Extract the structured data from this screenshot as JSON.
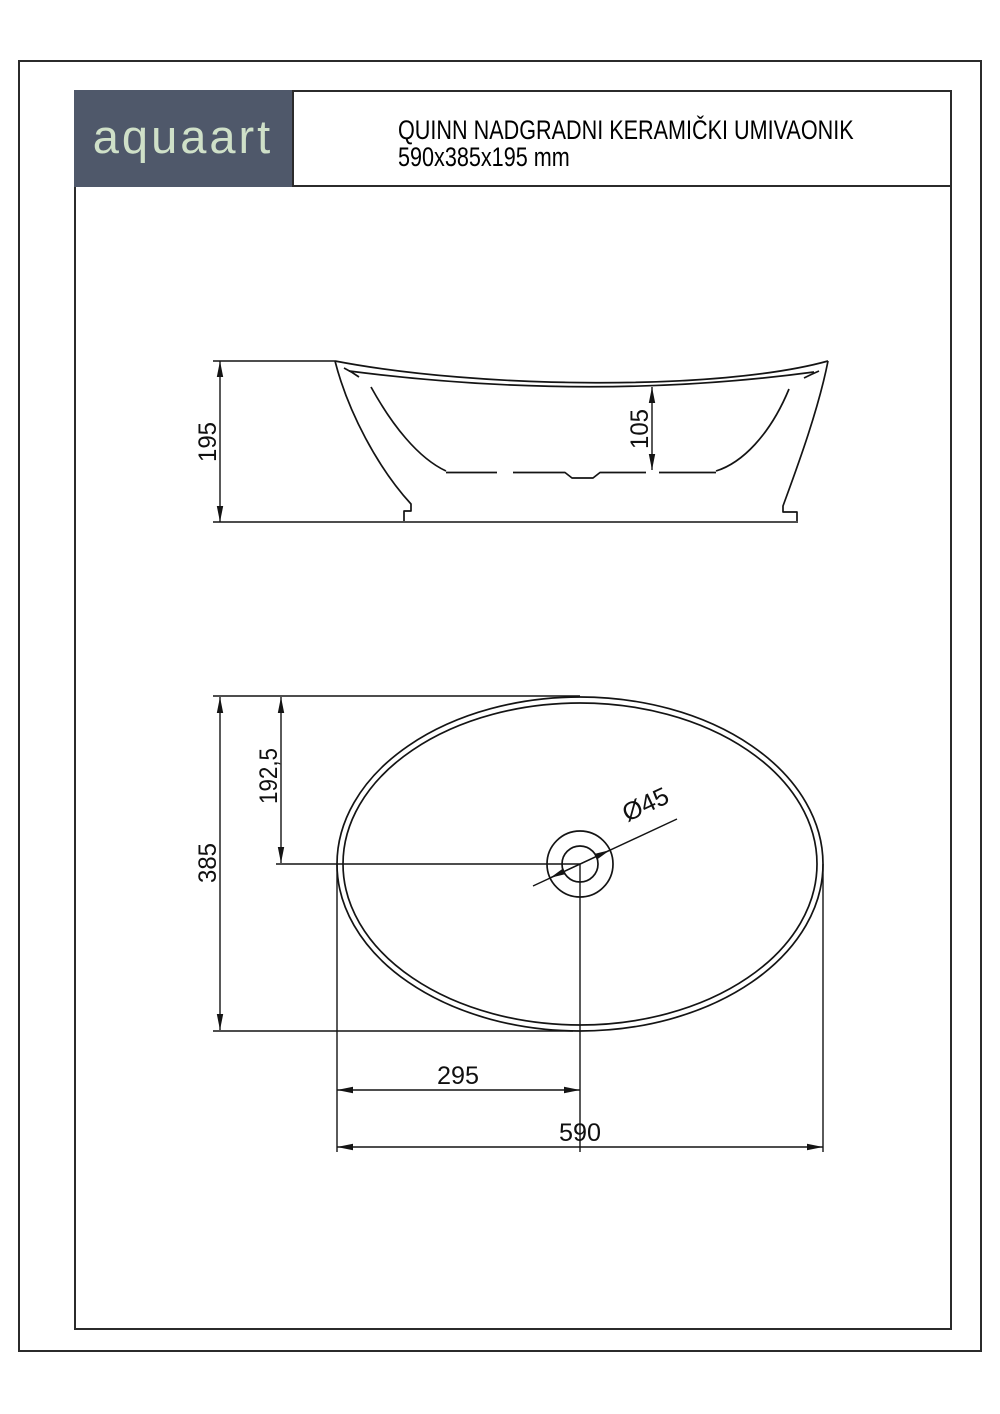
{
  "header": {
    "logo_text": "aquaart",
    "title_line1": "QUINN NADGRADNI KERAMIČKI UMIVAONIK",
    "title_line2": "590x385x195 mm"
  },
  "drawing": {
    "side_view": {
      "overall_height": "195",
      "bowl_depth": "105"
    },
    "top_view": {
      "overall_width": "385",
      "center_offset_vertical": "192,5",
      "drain_diameter": "Ø45",
      "drain_offset_horizontal": "295",
      "overall_length": "590"
    }
  },
  "colors": {
    "logo_background": "#4f586a",
    "logo_text": "#cfe0c8",
    "line": "#141414"
  }
}
